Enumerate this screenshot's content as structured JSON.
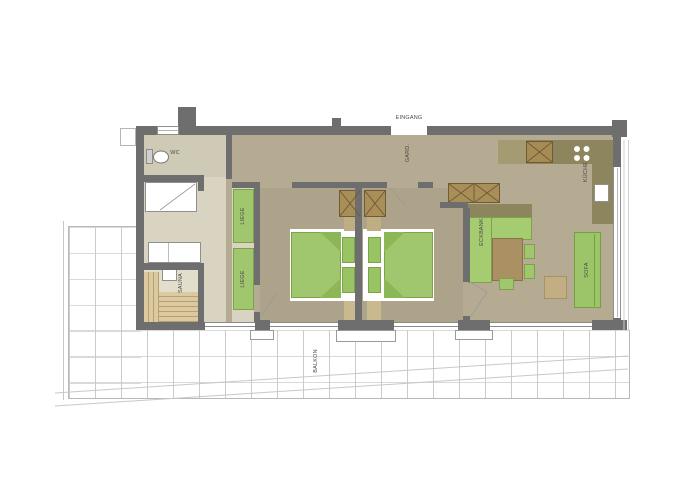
{
  "labels": {
    "entrance": "EINGANG",
    "cloakroom": "GARD.",
    "wc": "WC",
    "sauna": "SAUNA",
    "lounger_top": "LIEGE",
    "lounger_bottom": "LIEGE",
    "kitchen": "KÜCHE",
    "corner_bench": "ECKBANK",
    "sofa": "SOFA",
    "balcony": "BALKON"
  },
  "colors": {
    "wall": "#6e6e6e",
    "floor_living": "#b4ab92",
    "floor_bedroom": "#aca38a",
    "floor_wellness": "#d9d4c1",
    "floor_wc": "#cfcab6",
    "floor_sauna": "#e3decb",
    "furniture_green": "#a0c76d",
    "furniture_green_dark": "#8cb757",
    "wood_dark": "#a98e58",
    "wood_light": "#c9b98f",
    "kitchen_counter": "#8d855e",
    "table_wood": "#ab9064",
    "sauna_wood": "#dcc9a0",
    "terrace_grid_line": "#cbcbcb",
    "label_text": "#4a4a4a"
  }
}
